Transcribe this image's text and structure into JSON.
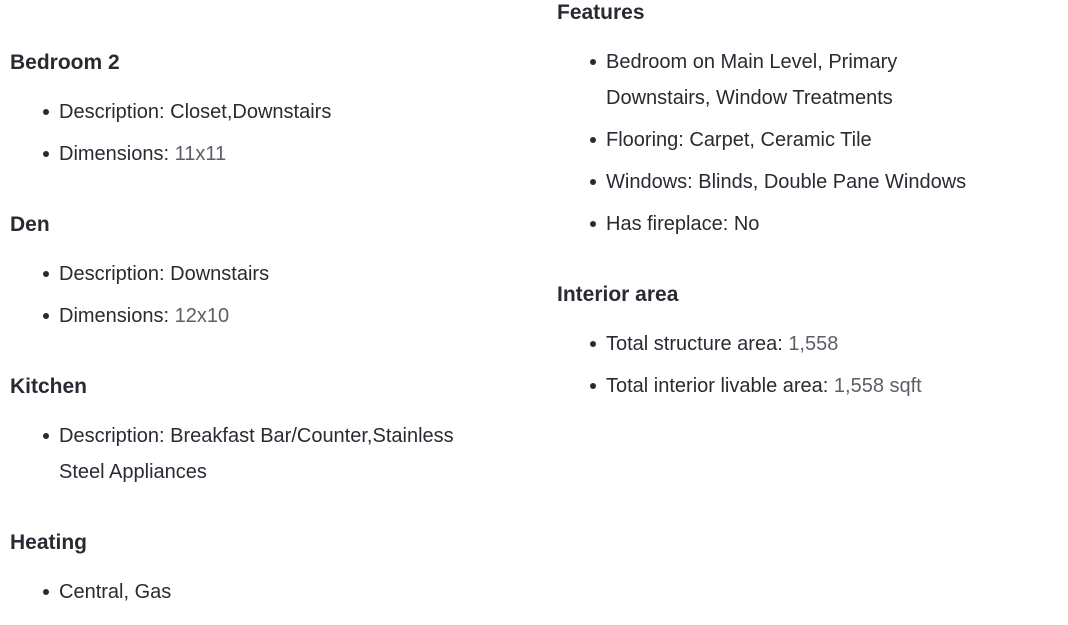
{
  "colors": {
    "heading": "#2a2a33",
    "text": "#2a2a33",
    "muted_value": "#5b5f68",
    "bullet": "#2a2a33",
    "background": "#ffffff"
  },
  "columns": [
    {
      "name": "left",
      "sections": [
        {
          "title": "Bedroom 2",
          "items": [
            {
              "segments": [
                {
                  "text": "Description: Closet,Downstairs",
                  "muted": false
                }
              ]
            },
            {
              "segments": [
                {
                  "text": "Dimensions: ",
                  "muted": false
                },
                {
                  "text": "11x11",
                  "muted": true
                }
              ]
            }
          ]
        },
        {
          "title": "Den",
          "items": [
            {
              "segments": [
                {
                  "text": "Description: Downstairs",
                  "muted": false
                }
              ]
            },
            {
              "segments": [
                {
                  "text": "Dimensions: ",
                  "muted": false
                },
                {
                  "text": "12x10",
                  "muted": true
                }
              ]
            }
          ]
        },
        {
          "title": "Kitchen",
          "items": [
            {
              "segments": [
                {
                  "text": "Description: Breakfast Bar/Counter,Stainless Steel Appliances",
                  "muted": false
                }
              ]
            }
          ]
        },
        {
          "title": "Heating",
          "items": [
            {
              "segments": [
                {
                  "text": "Central, Gas",
                  "muted": false
                }
              ]
            }
          ]
        }
      ]
    },
    {
      "name": "right",
      "sections": [
        {
          "title": "Features",
          "items": [
            {
              "segments": [
                {
                  "text": "Bedroom on Main Level, Primary Downstairs, Window Treatments",
                  "muted": false
                }
              ]
            },
            {
              "segments": [
                {
                  "text": "Flooring: Carpet, Ceramic Tile",
                  "muted": false
                }
              ]
            },
            {
              "segments": [
                {
                  "text": "Windows: Blinds, Double Pane Windows",
                  "muted": false
                }
              ]
            },
            {
              "segments": [
                {
                  "text": "Has fireplace: No",
                  "muted": false
                }
              ]
            }
          ]
        },
        {
          "title": "Interior area",
          "items": [
            {
              "segments": [
                {
                  "text": "Total structure area: ",
                  "muted": false
                },
                {
                  "text": "1,558",
                  "muted": true
                }
              ]
            },
            {
              "segments": [
                {
                  "text": "Total interior livable area: ",
                  "muted": false
                },
                {
                  "text": "1,558 sqft",
                  "muted": true
                }
              ]
            }
          ]
        }
      ]
    }
  ]
}
